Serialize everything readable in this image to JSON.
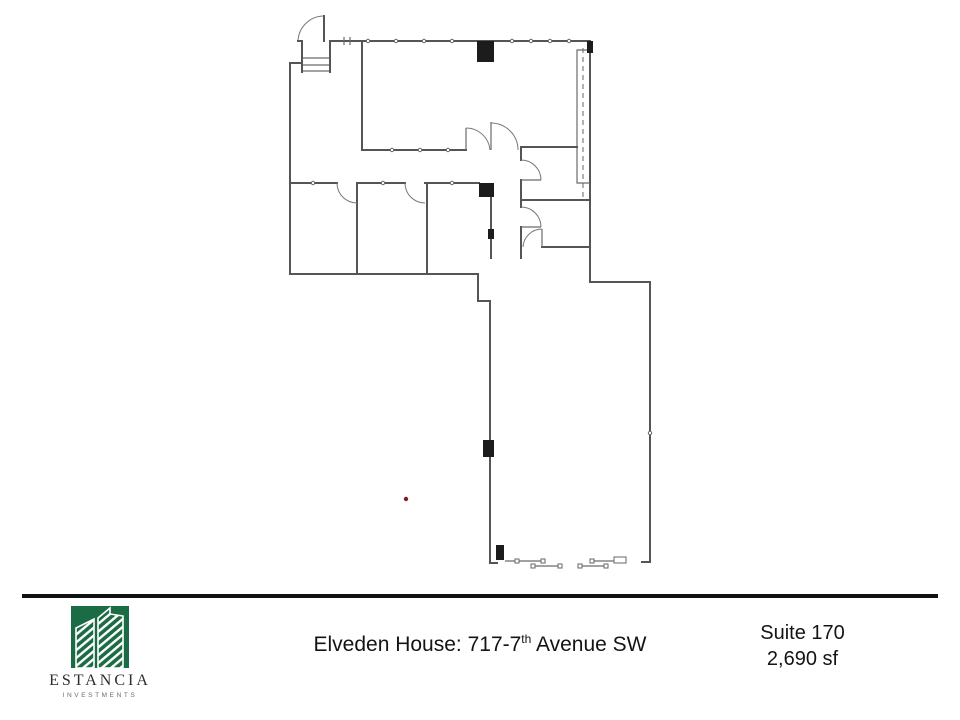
{
  "page": {
    "background": "#ffffff"
  },
  "floorplan": {
    "label": "suite-floor-plan-drawing",
    "wall_color": "#555555",
    "column_color": "#1c1c1c",
    "marker_dot_color": "#7b2125"
  },
  "footer": {
    "divider_color": "#111111",
    "logo": {
      "brand": "ESTANCIA",
      "tagline": "INVESTMENTS",
      "color": "#1b6b44"
    },
    "address": {
      "prefix": "Elveden House:  717-7",
      "ordinal": "th",
      "suffix": " Avenue SW"
    },
    "suite_label": "Suite 170",
    "area_label": "2,690 sf"
  }
}
